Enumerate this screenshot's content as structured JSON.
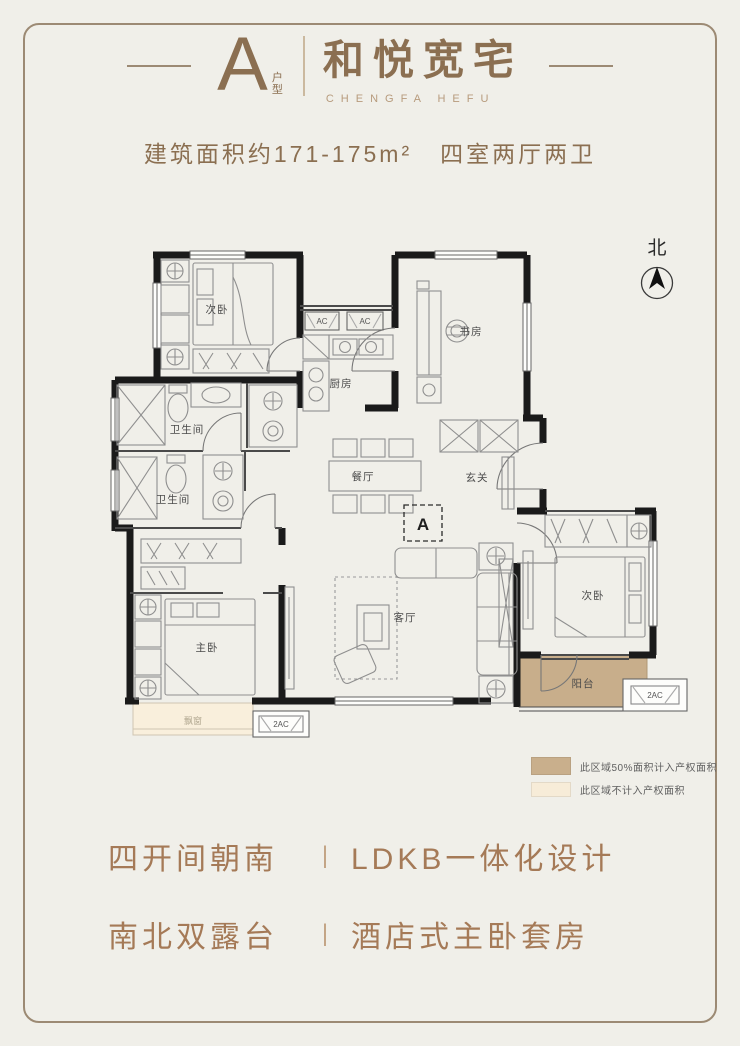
{
  "header": {
    "unit_letter": "A",
    "unit_label": "户型",
    "title": "和悦宽宅",
    "subtitle": "CHENGFA HEFU",
    "area_info": "建筑面积约171-175m²",
    "layout_info": "四室两厅两卫"
  },
  "compass": {
    "label": "北"
  },
  "plan": {
    "marker": "A",
    "rooms": [
      {
        "id": "bedroom-north",
        "label": "次卧"
      },
      {
        "id": "study",
        "label": "书房"
      },
      {
        "id": "kitchen",
        "label": "厨房"
      },
      {
        "id": "bathroom-1",
        "label": "卫生间"
      },
      {
        "id": "bathroom-2",
        "label": "卫生间"
      },
      {
        "id": "dining",
        "label": "餐厅"
      },
      {
        "id": "foyer",
        "label": "玄关"
      },
      {
        "id": "master-bedroom",
        "label": "主卧"
      },
      {
        "id": "living",
        "label": "客厅"
      },
      {
        "id": "bedroom-east",
        "label": "次卧"
      },
      {
        "id": "balcony",
        "label": "阳台"
      },
      {
        "id": "bay-window",
        "label": "飘窗"
      }
    ],
    "ac_units": [
      "AC",
      "AC",
      "2AC",
      "2AC"
    ],
    "colors": {
      "wall": "#1a1a1a",
      "balcony_fill": "#c8ae8b",
      "bay_window_fill": "#f9efdc"
    }
  },
  "legend": {
    "items": [
      {
        "swatch": "#c9af8c",
        "text": "此区域50%面积计入产权面积"
      },
      {
        "swatch": "#f7ecd8",
        "text": "此区域不计入产权面积"
      }
    ]
  },
  "features": {
    "divider": "|",
    "rows": [
      {
        "left": "四开间朝南",
        "right": "LDKB一体化设计"
      },
      {
        "left": "南北双露台",
        "right": "酒店式主卧套房"
      }
    ]
  },
  "page_colors": {
    "background": "#f0efe9",
    "frame_border": "#9c8a74",
    "title_brown": "#8b6f51",
    "feature_brown": "#a57a57"
  }
}
